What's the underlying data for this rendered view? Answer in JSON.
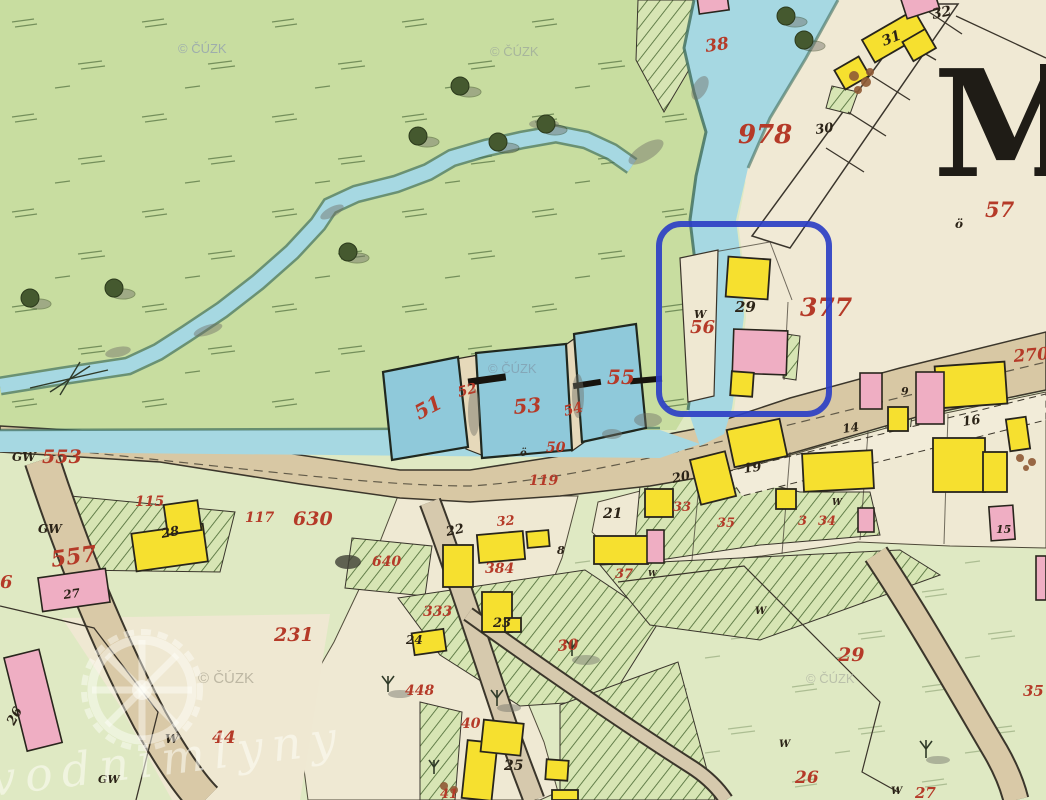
{
  "map": {
    "place_letter": "M",
    "annotation_color": "#2d3fc4",
    "watermark_site": "vodnimlyny",
    "palette": {
      "meadow": "#c8dda0",
      "field": "#dfe9c3",
      "water": "#a6d8e2",
      "pond": "#8fc9da",
      "road": "#d8c8a4",
      "paper": "#f0e9d4",
      "building_wood": "#f6e02f",
      "building_stone": "#efaec3",
      "parcel_number_red": "#b53a28",
      "ink_black": "#2b2317",
      "highlight_blue": "#2d3fc4"
    },
    "labels": {
      "red": [
        {
          "text": "978",
          "x": 738,
          "y": 143,
          "size": 26
        },
        {
          "text": "57",
          "x": 985,
          "y": 217,
          "size": 21
        },
        {
          "text": "377",
          "x": 800,
          "y": 316,
          "size": 25
        },
        {
          "text": "270",
          "x": 1014,
          "y": 362,
          "size": 17,
          "rot": -5
        },
        {
          "text": "38",
          "x": 706,
          "y": 52,
          "size": 17,
          "rot": -8
        },
        {
          "text": "55",
          "x": 607,
          "y": 384,
          "size": 20
        },
        {
          "text": "51",
          "x": 419,
          "y": 420,
          "size": 20,
          "rot": -28
        },
        {
          "text": "52",
          "x": 459,
          "y": 397,
          "size": 14,
          "rot": -15
        },
        {
          "text": "53",
          "x": 514,
          "y": 414,
          "size": 20,
          "rot": -5
        },
        {
          "text": "54",
          "x": 565,
          "y": 416,
          "size": 14,
          "rot": -15
        },
        {
          "text": "50",
          "x": 546,
          "y": 452,
          "size": 14
        },
        {
          "text": "56",
          "x": 690,
          "y": 333,
          "size": 18
        },
        {
          "text": "119",
          "x": 529,
          "y": 485,
          "size": 14
        },
        {
          "text": "553",
          "x": 42,
          "y": 463,
          "size": 19
        },
        {
          "text": "557",
          "x": 52,
          "y": 567,
          "size": 22,
          "rot": -8
        },
        {
          "text": "6",
          "x": 0,
          "y": 588,
          "size": 18
        },
        {
          "text": "115",
          "x": 135,
          "y": 506,
          "size": 14
        },
        {
          "text": "117",
          "x": 245,
          "y": 522,
          "size": 14
        },
        {
          "text": "630",
          "x": 293,
          "y": 525,
          "size": 19
        },
        {
          "text": "640",
          "x": 372,
          "y": 566,
          "size": 14
        },
        {
          "text": "231",
          "x": 274,
          "y": 641,
          "size": 19
        },
        {
          "text": "333",
          "x": 423,
          "y": 616,
          "size": 14
        },
        {
          "text": "384",
          "x": 485,
          "y": 573,
          "size": 14
        },
        {
          "text": "32",
          "x": 497,
          "y": 526,
          "size": 13,
          "rot": -5
        },
        {
          "text": "30",
          "x": 558,
          "y": 651,
          "size": 15,
          "rot": -5
        },
        {
          "text": "448",
          "x": 405,
          "y": 695,
          "size": 14
        },
        {
          "text": "40",
          "x": 461,
          "y": 728,
          "size": 14
        },
        {
          "text": "41",
          "x": 440,
          "y": 798,
          "size": 13
        },
        {
          "text": "44",
          "x": 212,
          "y": 743,
          "size": 17
        },
        {
          "text": "37",
          "x": 615,
          "y": 578,
          "size": 13
        },
        {
          "text": "33",
          "x": 673,
          "y": 511,
          "size": 13
        },
        {
          "text": "35",
          "x": 717,
          "y": 527,
          "size": 13
        },
        {
          "text": "3",
          "x": 798,
          "y": 525,
          "size": 13
        },
        {
          "text": "34",
          "x": 818,
          "y": 525,
          "size": 13
        },
        {
          "text": "29",
          "x": 838,
          "y": 661,
          "size": 19
        },
        {
          "text": "26",
          "x": 795,
          "y": 783,
          "size": 17
        },
        {
          "text": "27",
          "x": 915,
          "y": 798,
          "size": 15
        },
        {
          "text": "35",
          "x": 1023,
          "y": 696,
          "size": 15
        }
      ],
      "black": [
        {
          "text": "32",
          "x": 933,
          "y": 19,
          "size": 14,
          "rot": -12
        },
        {
          "text": "31",
          "x": 884,
          "y": 46,
          "size": 14,
          "rot": -22
        },
        {
          "text": "30",
          "x": 816,
          "y": 134,
          "size": 13,
          "rot": -8
        },
        {
          "text": "29",
          "x": 735,
          "y": 312,
          "size": 15
        },
        {
          "text": "W",
          "x": 694,
          "y": 318,
          "size": 11
        },
        {
          "text": "ö",
          "x": 955,
          "y": 228,
          "size": 12
        },
        {
          "text": "ö",
          "x": 520,
          "y": 456,
          "size": 10
        },
        {
          "text": "8",
          "x": 557,
          "y": 554,
          "size": 11
        },
        {
          "text": "21",
          "x": 603,
          "y": 518,
          "size": 14
        },
        {
          "text": "22",
          "x": 447,
          "y": 536,
          "size": 13,
          "rot": -12
        },
        {
          "text": "23",
          "x": 493,
          "y": 627,
          "size": 13
        },
        {
          "text": "24",
          "x": 406,
          "y": 644,
          "size": 12
        },
        {
          "text": "25",
          "x": 504,
          "y": 770,
          "size": 14
        },
        {
          "text": "26",
          "x": 14,
          "y": 726,
          "size": 13,
          "rot": -62
        },
        {
          "text": "27",
          "x": 64,
          "y": 599,
          "size": 12,
          "rot": -8
        },
        {
          "text": "28",
          "x": 162,
          "y": 538,
          "size": 13,
          "rot": -10
        },
        {
          "text": "20",
          "x": 673,
          "y": 483,
          "size": 13,
          "rot": -12
        },
        {
          "text": "19",
          "x": 744,
          "y": 473,
          "size": 13,
          "rot": -8
        },
        {
          "text": "14",
          "x": 843,
          "y": 433,
          "size": 12,
          "rot": -8
        },
        {
          "text": "16",
          "x": 963,
          "y": 426,
          "size": 13,
          "rot": -8
        },
        {
          "text": "15",
          "x": 996,
          "y": 533,
          "size": 11
        },
        {
          "text": "9",
          "x": 901,
          "y": 395,
          "size": 11
        },
        {
          "text": "GW",
          "x": 12,
          "y": 461,
          "size": 12
        },
        {
          "text": "GW",
          "x": 38,
          "y": 533,
          "size": 12
        },
        {
          "text": "GW",
          "x": 98,
          "y": 783,
          "size": 11
        },
        {
          "text": "W",
          "x": 165,
          "y": 743,
          "size": 12
        },
        {
          "text": "W",
          "x": 648,
          "y": 576,
          "size": 8
        },
        {
          "text": "W",
          "x": 832,
          "y": 505,
          "size": 9
        },
        {
          "text": "W",
          "x": 755,
          "y": 614,
          "size": 10
        },
        {
          "text": "W",
          "x": 779,
          "y": 747,
          "size": 10
        },
        {
          "text": "W",
          "x": 891,
          "y": 794,
          "size": 10
        }
      ],
      "watermarks": [
        {
          "text": "© ČÚZK",
          "x": 178,
          "y": 53,
          "size": 13,
          "color": "#8d9ab2"
        },
        {
          "text": "© ČÚZK",
          "x": 490,
          "y": 56,
          "size": 13,
          "color": "#9aa59b"
        },
        {
          "text": "© ČÚZK",
          "x": 488,
          "y": 373,
          "size": 13,
          "color": "#8099aa"
        },
        {
          "text": "© ČÚZK",
          "x": 198,
          "y": 683,
          "size": 15,
          "color": "#a8a390"
        },
        {
          "text": "© ČÚZK",
          "x": 806,
          "y": 683,
          "size": 13,
          "color": "#abafa0"
        }
      ]
    }
  }
}
